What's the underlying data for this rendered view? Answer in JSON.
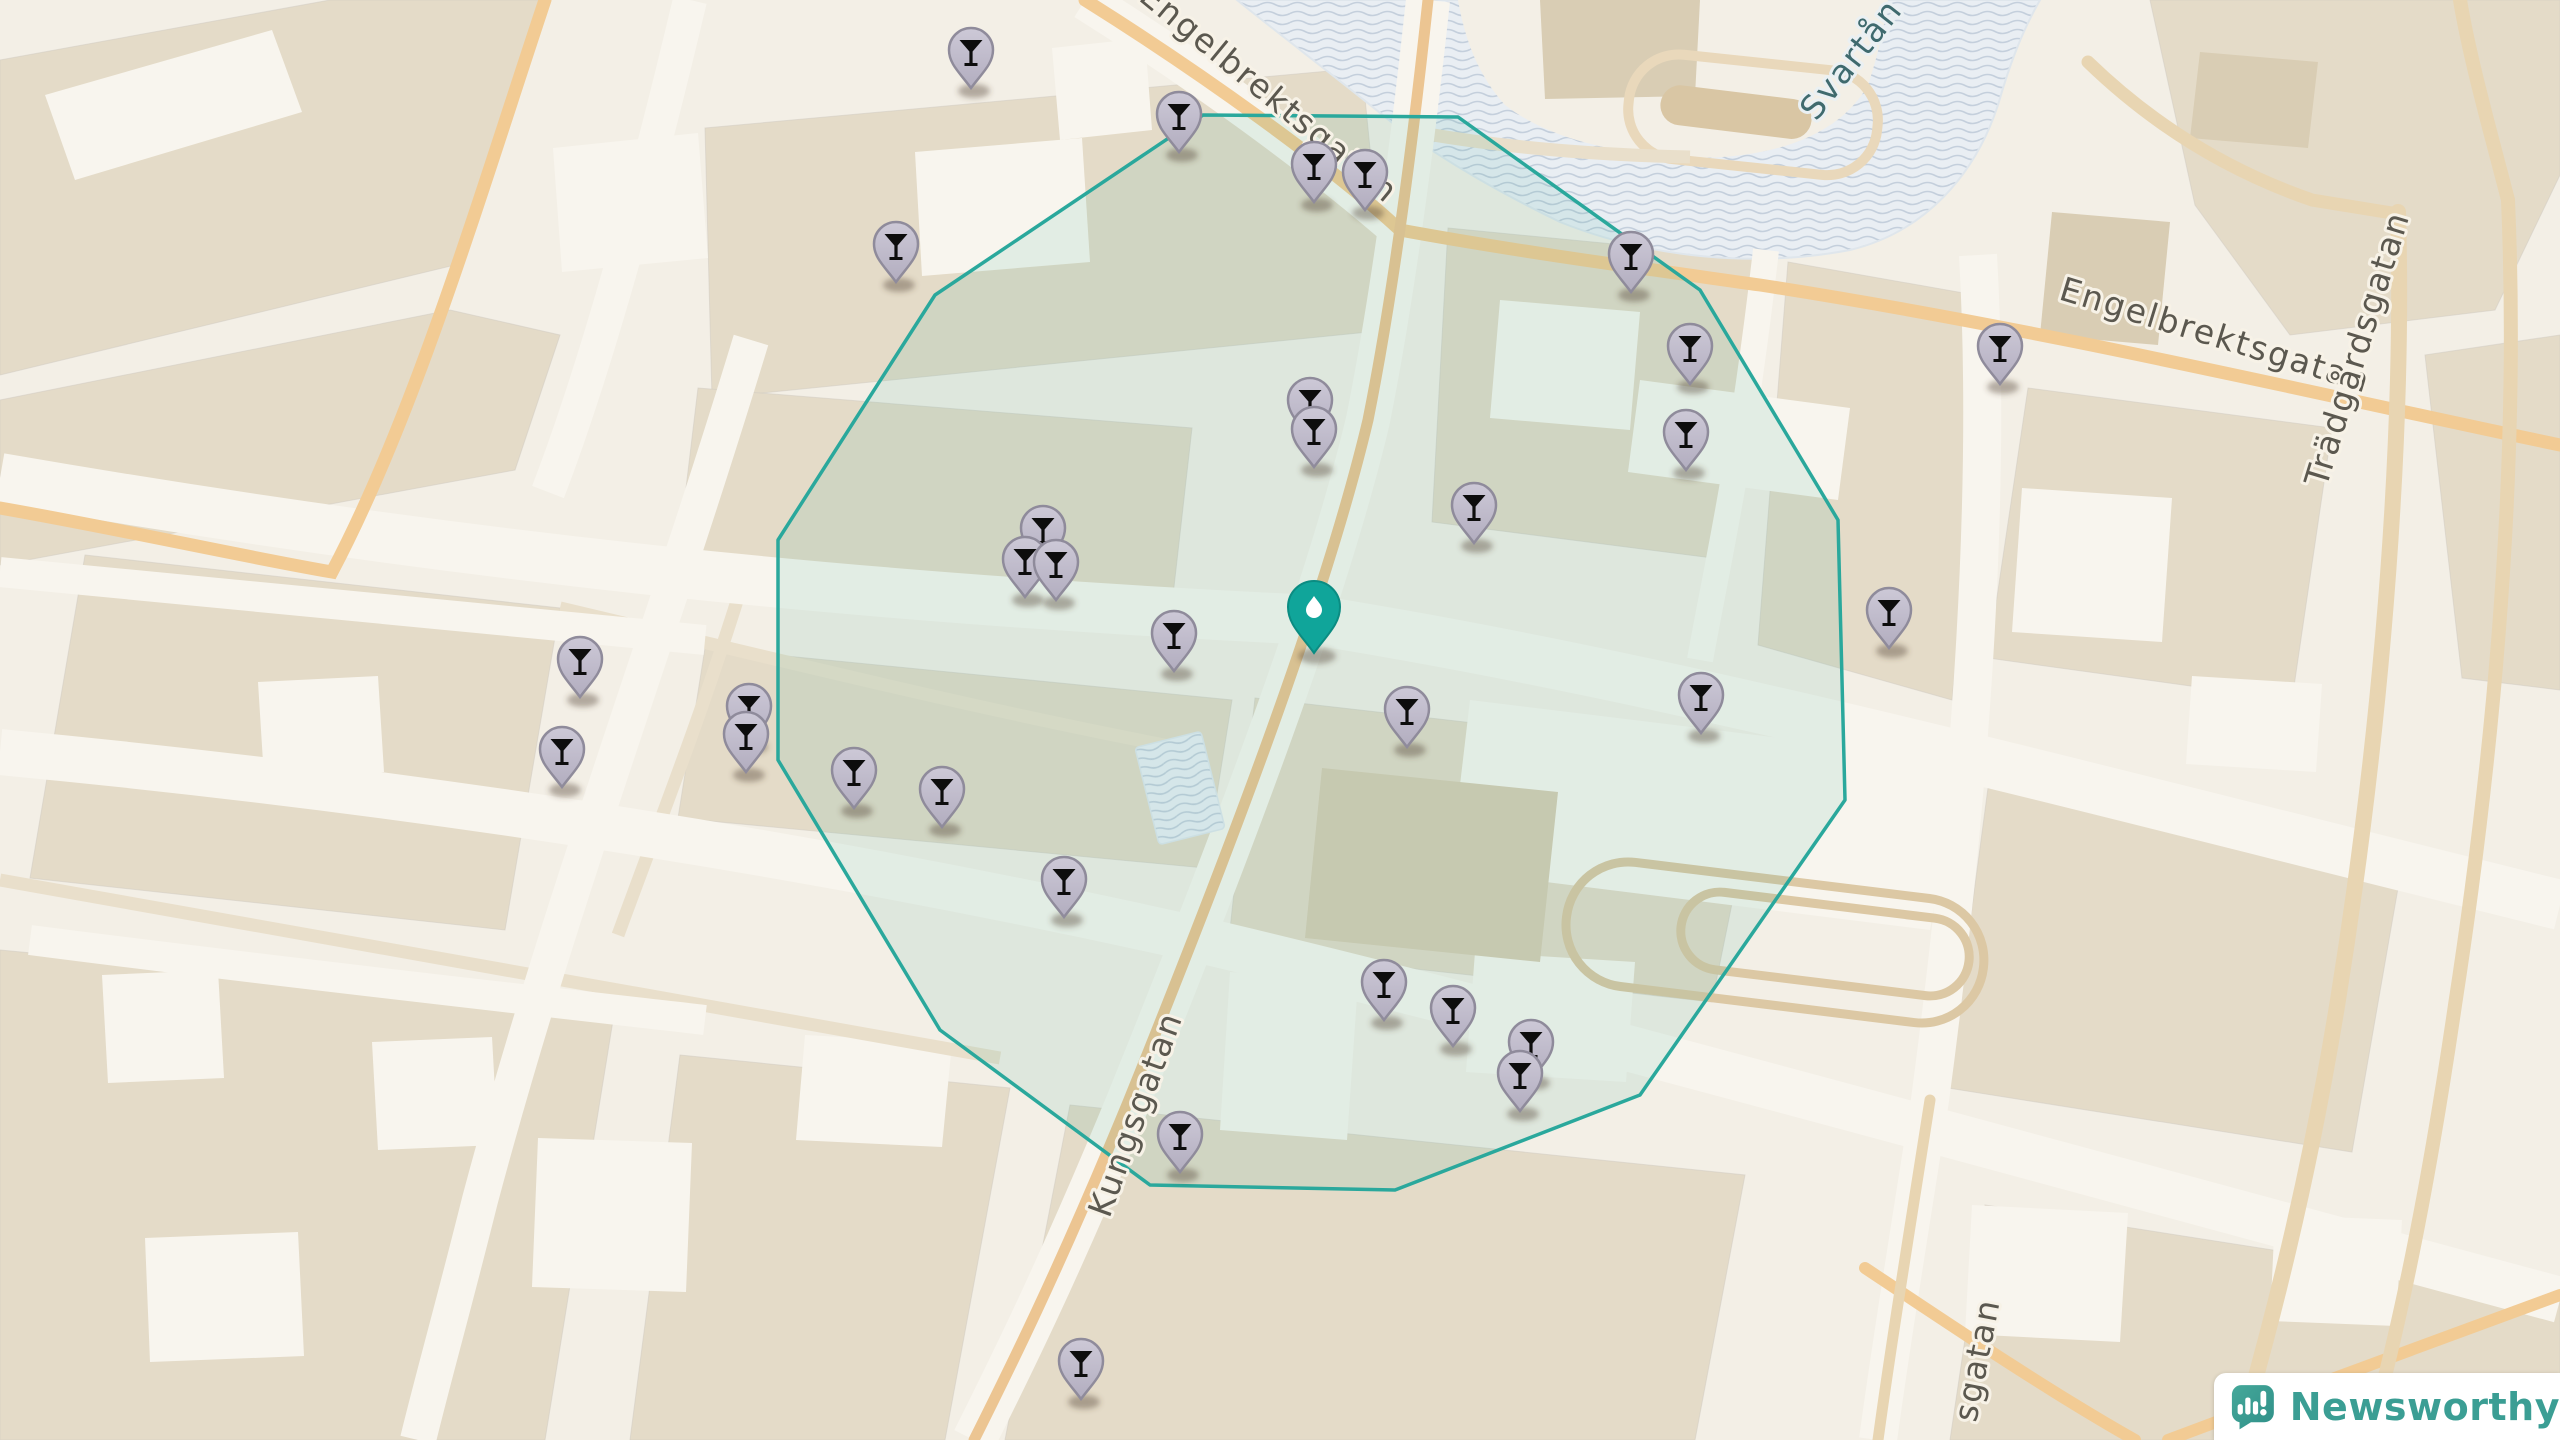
{
  "map": {
    "street_labels": [
      {
        "text": "Engelbrektsgatan",
        "transform": "translate(1262,102) rotate(39.5)",
        "water": false
      },
      {
        "text": "Engelbrektsgatan",
        "transform": "translate(2212,346) rotate(17)",
        "water": false
      },
      {
        "text": "Trädgårdsgatan",
        "transform": "translate(2368,352) rotate(-73)",
        "water": false
      },
      {
        "text": "Svartån",
        "transform": "translate(1860,66) rotate(-52)",
        "water": true
      },
      {
        "text": "Kungsgatan",
        "transform": "translate(1146,1118) rotate(-70)",
        "water": false
      },
      {
        "text": "sgatan",
        "transform": "translate(1988,1362) rotate(-79)",
        "water": false
      }
    ],
    "bar_markers": [
      {
        "x": 971,
        "y": 54
      },
      {
        "x": 1179,
        "y": 118
      },
      {
        "x": 1314,
        "y": 168
      },
      {
        "x": 1365,
        "y": 176
      },
      {
        "x": 896,
        "y": 248
      },
      {
        "x": 1631,
        "y": 258
      },
      {
        "x": 1690,
        "y": 350
      },
      {
        "x": 2000,
        "y": 350
      },
      {
        "x": 1686,
        "y": 436
      },
      {
        "x": 1310,
        "y": 404
      },
      {
        "x": 1314,
        "y": 433
      },
      {
        "x": 1474,
        "y": 509
      },
      {
        "x": 1043,
        "y": 532
      },
      {
        "x": 1025,
        "y": 563
      },
      {
        "x": 1056,
        "y": 566
      },
      {
        "x": 1174,
        "y": 637
      },
      {
        "x": 1889,
        "y": 614
      },
      {
        "x": 580,
        "y": 663
      },
      {
        "x": 1701,
        "y": 699
      },
      {
        "x": 1407,
        "y": 713
      },
      {
        "x": 749,
        "y": 710
      },
      {
        "x": 746,
        "y": 738
      },
      {
        "x": 562,
        "y": 753
      },
      {
        "x": 854,
        "y": 774
      },
      {
        "x": 942,
        "y": 793
      },
      {
        "x": 1064,
        "y": 883
      },
      {
        "x": 1384,
        "y": 986
      },
      {
        "x": 1453,
        "y": 1012
      },
      {
        "x": 1531,
        "y": 1046
      },
      {
        "x": 1520,
        "y": 1077
      },
      {
        "x": 1180,
        "y": 1138
      },
      {
        "x": 1081,
        "y": 1365
      }
    ],
    "center_marker": {
      "x": 1314,
      "y": 612
    },
    "radius_polygon_points": "1203,115 1458,117 1700,290 1838,520 1845,800 1640,1095 1395,1190 1150,1185 940,1030 778,760 778,540 935,295",
    "colors": {
      "accent_teal": "#2aa89c",
      "center_pin": "#10a59a",
      "marker_fill": "#c6c2d0",
      "marker_border": "#8f8b9b",
      "water": "#e9eef3",
      "wave_line": "#c4cfdc",
      "logo_teal": "#3b9e94"
    }
  },
  "branding": {
    "logo_text": "Newsworthy"
  }
}
